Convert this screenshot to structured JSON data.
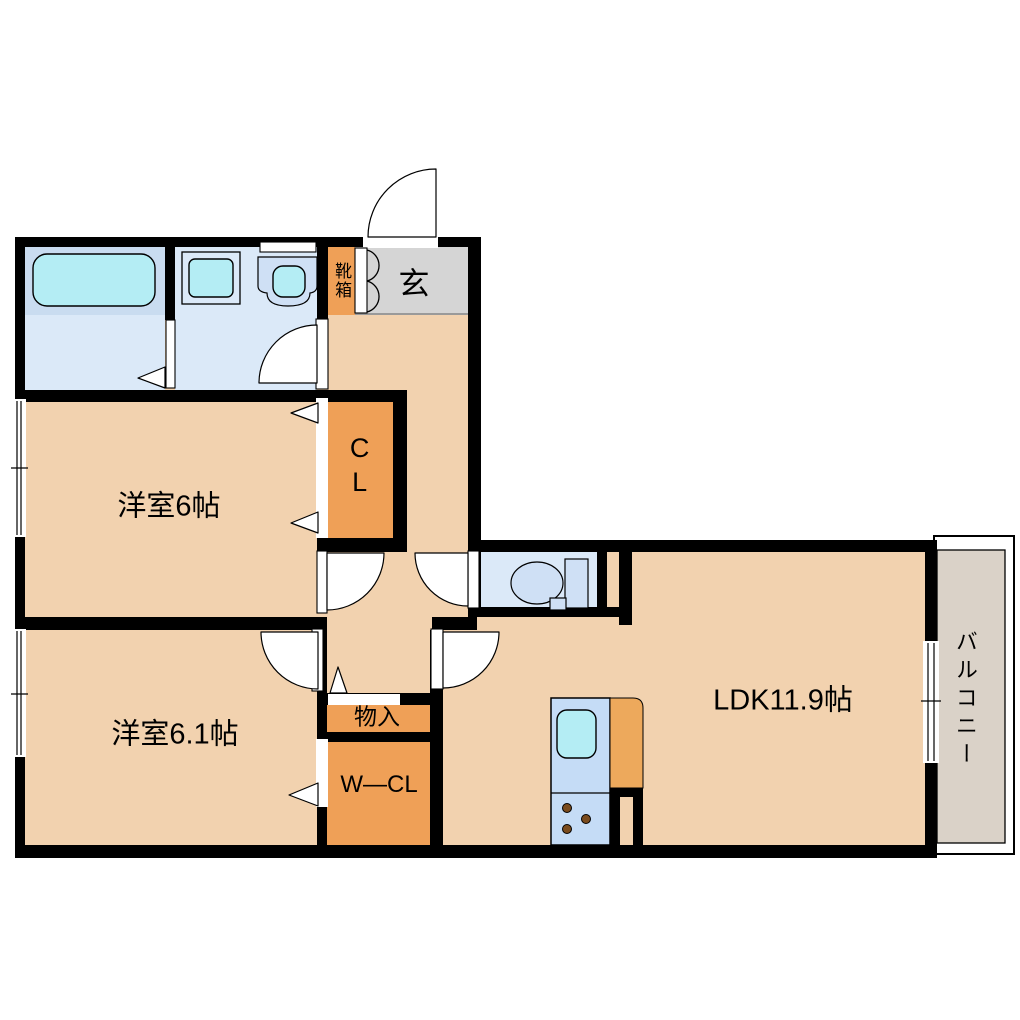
{
  "floorplan": {
    "labels": {
      "bedroom1": "洋室6帖",
      "bedroom2": "洋室6.1帖",
      "ldk": "LDK11.9帖",
      "closet": "CL",
      "walk_in_closet": "W―CL",
      "storage": "物入",
      "entrance": "玄",
      "shoe_cabinet": "靴箱",
      "balcony": "バルコニー"
    },
    "colors": {
      "wall": "#000000",
      "room_floor": "#f2d2af",
      "closet_orange": "#efa057",
      "counter_orange": "#eda95c",
      "entrance_gray": "#d5d5d5",
      "balcony_gray": "#dad2c8",
      "wet_floor": "#dbe9f8",
      "bath_zone": "#c9dcf0",
      "fixture_cyan": "#b4edf4",
      "fixture_blue": "#cfe0f5",
      "kitchen_blue": "#c5dcf6",
      "burner_brown": "#7a4b1d",
      "background": "#ffffff"
    }
  }
}
